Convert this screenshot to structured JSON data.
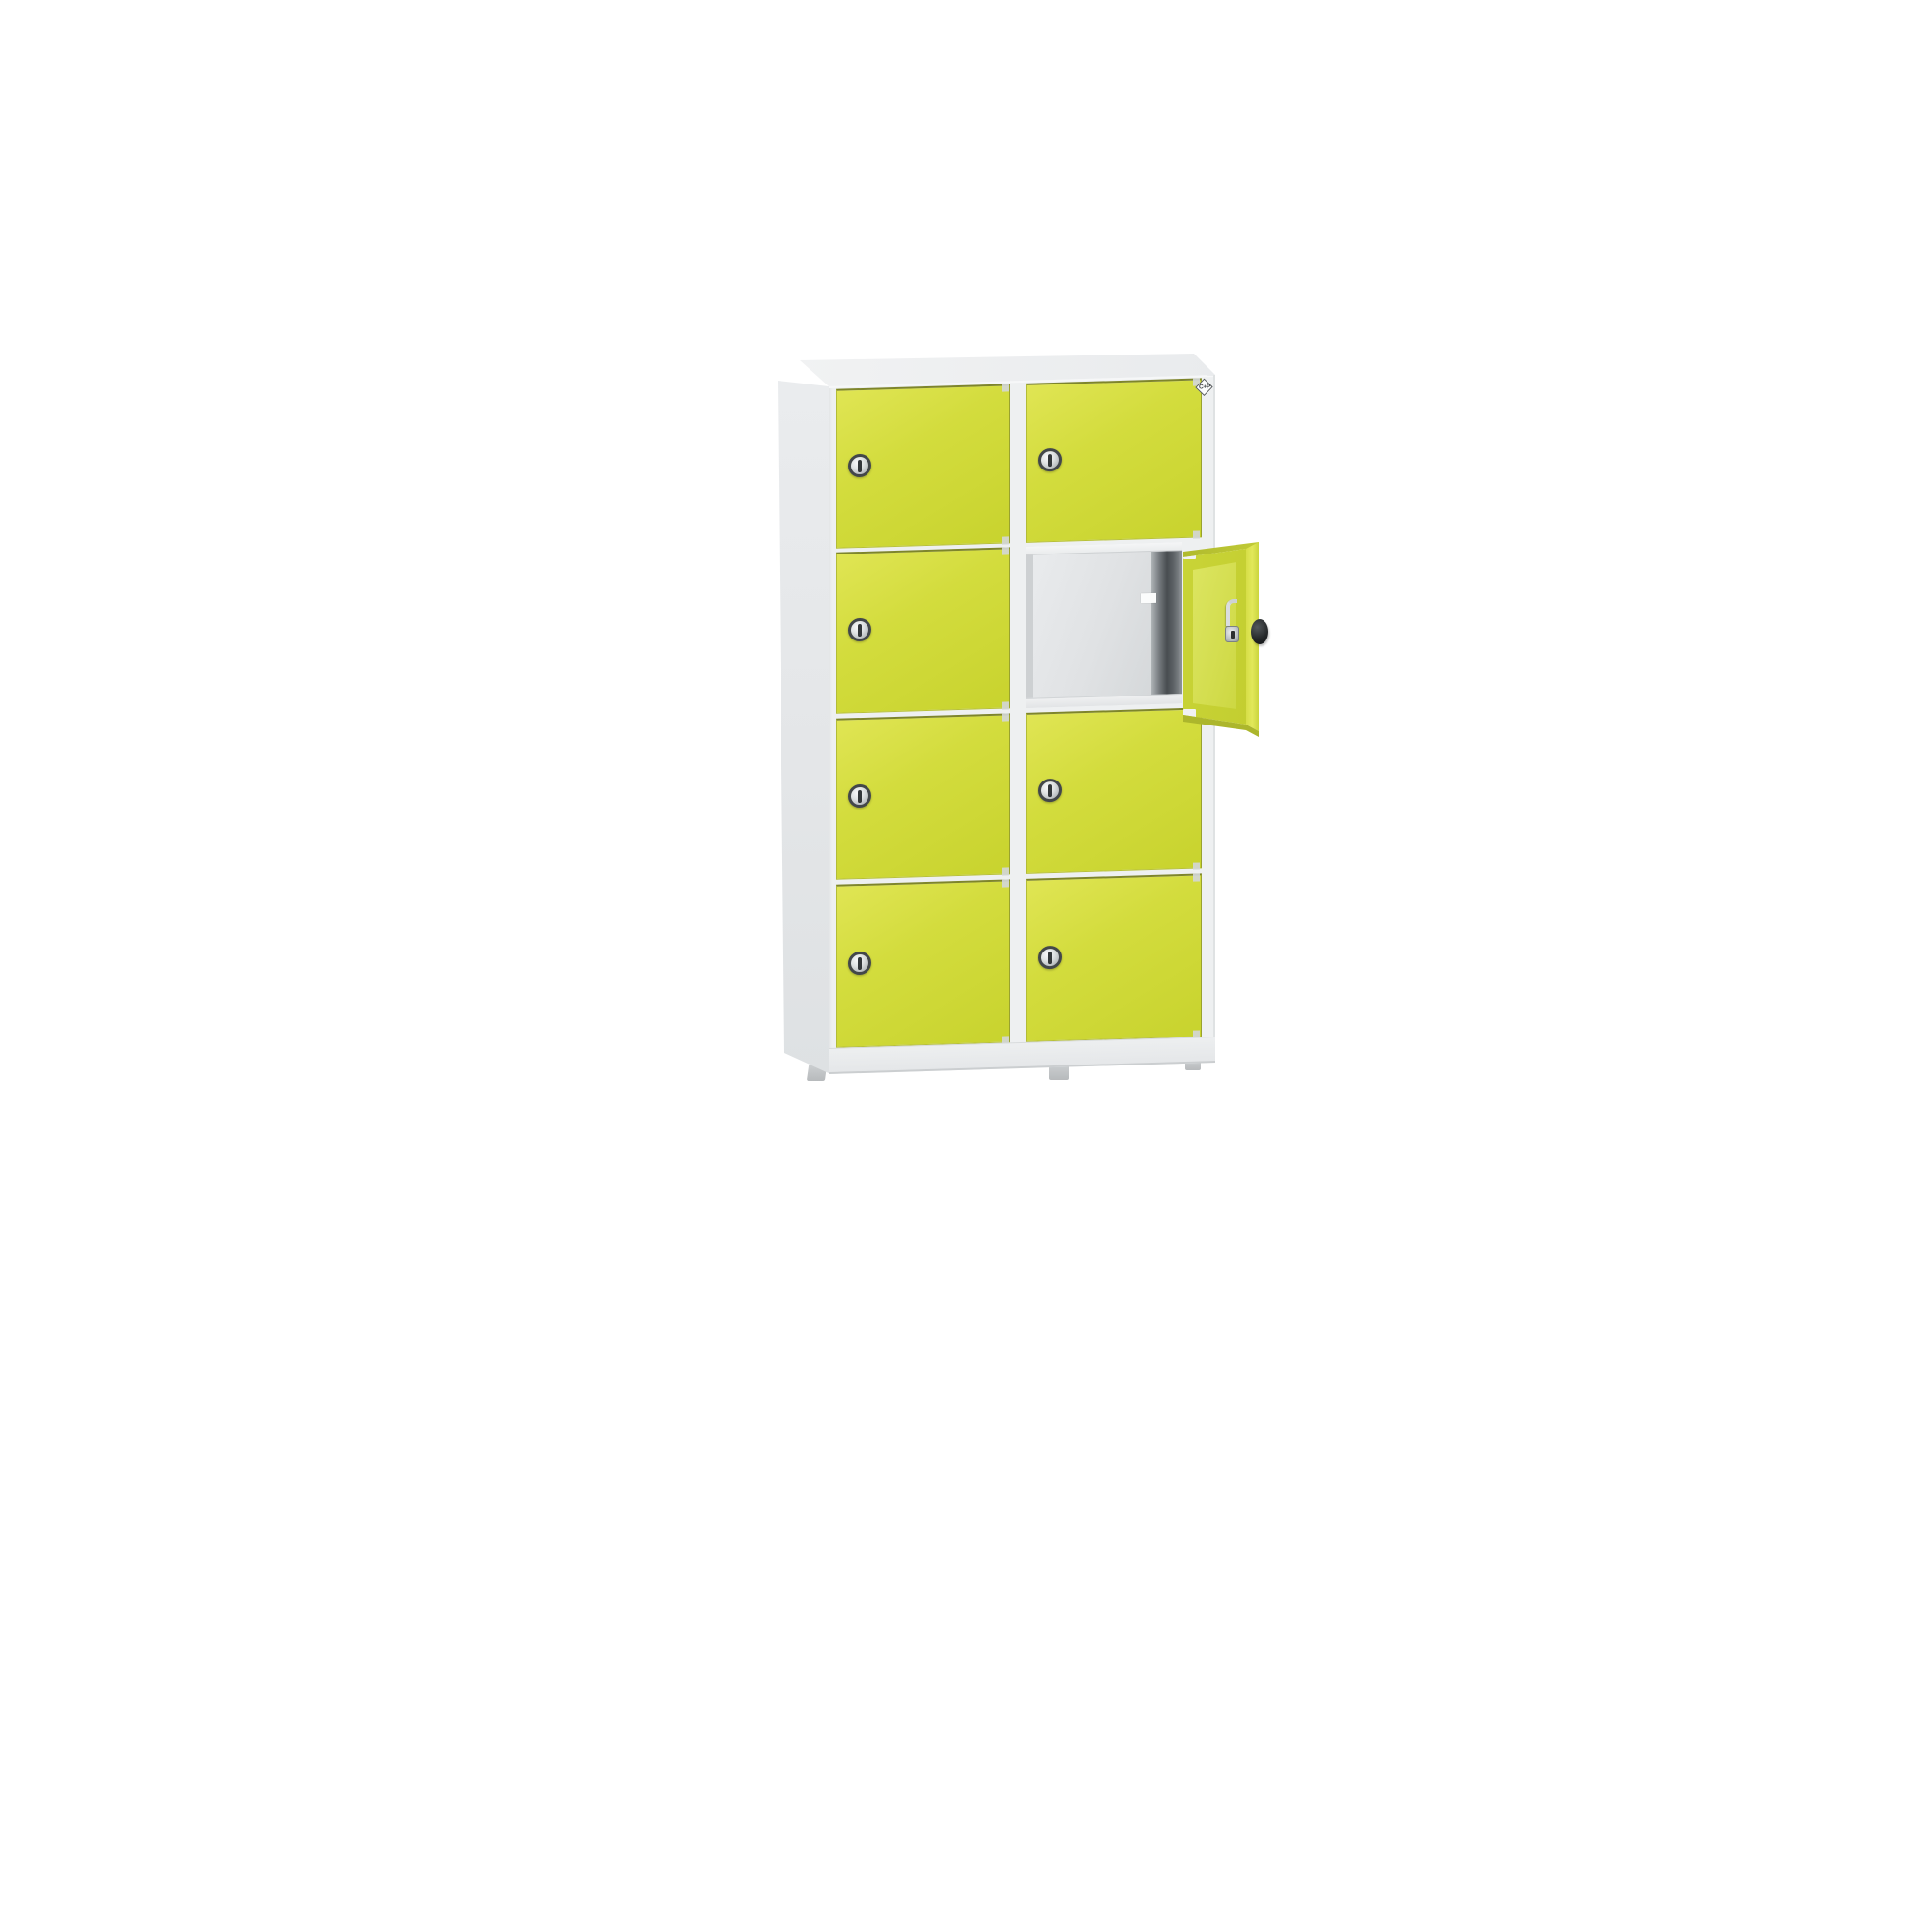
{
  "scene": {
    "background_color": "#ffffff",
    "description": "Product photo of a metal multi-compartment locker cabinet on white background"
  },
  "brand": {
    "logo_text": "C+P",
    "logo_shape": "diamond-outline"
  },
  "cabinet": {
    "columns": 2,
    "rows": 4,
    "total_compartments": 8,
    "closed_doors": 7,
    "open_doors": 1,
    "open_compartment": {
      "column": 2,
      "row": 2
    },
    "door_swing": "open to the right, approx 100 degrees",
    "lock_type": "round cylinder lock with vertical key slot, one per door",
    "interior": {
      "walls": "light grey",
      "right_wall_shadow": "dark grey",
      "label": "small white sticker on back wall"
    },
    "feet_visible": 3,
    "compartments": [
      {
        "column": 1,
        "row": 1,
        "state": "closed"
      },
      {
        "column": 1,
        "row": 2,
        "state": "closed"
      },
      {
        "column": 1,
        "row": 3,
        "state": "closed"
      },
      {
        "column": 1,
        "row": 4,
        "state": "closed"
      },
      {
        "column": 2,
        "row": 1,
        "state": "closed"
      },
      {
        "column": 2,
        "row": 2,
        "state": "open"
      },
      {
        "column": 2,
        "row": 3,
        "state": "closed"
      },
      {
        "column": 2,
        "row": 4,
        "state": "closed"
      }
    ]
  },
  "colors": {
    "door_face": "#d0da38",
    "door_face_highlight": "#e0e554",
    "door_gap_shadow": "#7e852b",
    "carcass": "#eef0f1",
    "carcass_side": "#e4e6e8",
    "interior_back": "#e0e2e4",
    "interior_dark_strip": "#484d50",
    "lock_ring": "#43474a",
    "lock_face_silver": "#dfe2e3",
    "knob_black": "#26292b",
    "latch_silver": "#dadde0",
    "feet_grey": "#c0c3c5",
    "background": "#ffffff"
  }
}
